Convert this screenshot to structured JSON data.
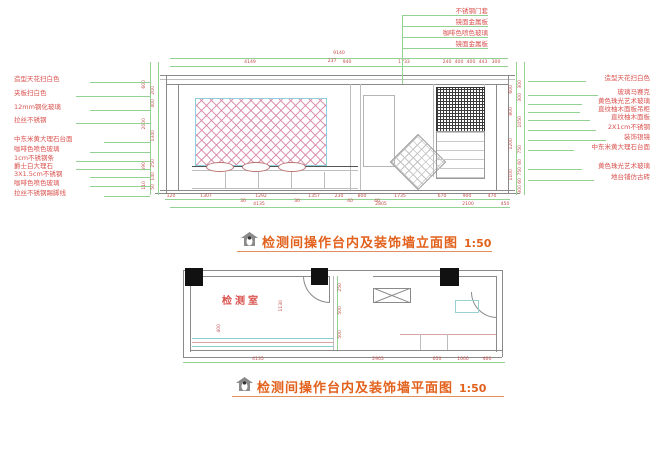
{
  "titles": {
    "elevation": {
      "text": "检测间操作台内及装饰墙立面图",
      "scale": "1:50"
    },
    "plan": {
      "text": "检测间操作台内及装饰墙平面图",
      "scale": "1:50"
    }
  },
  "colors": {
    "title_orange": "#e2611c",
    "callout_red": "#d9534f",
    "dim_red": "#c0504d",
    "dim_green": "#93d293",
    "line_gray": "#8a8a8a",
    "cyan": "#86cfcf",
    "hatch_pink": "#d884a6",
    "mosaic_dark": "#3a3a3a"
  },
  "elevation": {
    "top_callouts": [
      "不锈钢门套",
      "镜面金属板",
      "咖啡色喷色玻璃",
      "镜面金属板"
    ],
    "left_callouts": [
      "造型天花扫白色",
      "夹板扫白色",
      "12mm钢化玻璃",
      "拉丝不锈钢",
      "中东米黄大理石台面",
      "咖啡色喷色玻璃",
      "1cm不锈钢条",
      "爵士白大理石",
      "3X1.5cm不锈钢",
      "咖啡色喷色玻璃",
      "拉丝不锈钢踢脚线"
    ],
    "right_callouts": [
      "造型天花扫白色",
      "玻璃马赛克",
      "黄色珠光艺术玻璃",
      "直纹柚木面板吊柜",
      "直纹柚木面板",
      "2X1cm不锈钢",
      "装饰银镜",
      "中东米黄大理石台面",
      "黄色珠光艺术玻璃",
      "地台铺仿古砖"
    ],
    "dim_total": "9140",
    "dim_237": "237",
    "dims_top": [
      "4149",
      "940",
      "1733",
      "240",
      "400",
      "400",
      "443",
      "300"
    ],
    "dims_bottom_r1": [
      "120",
      "1307",
      "30",
      "1292",
      "30",
      "1357",
      "230",
      "40",
      "800",
      "40",
      "1735",
      "670",
      "900",
      "470"
    ],
    "dims_bottom_r2": [
      "4135",
      "2805",
      "2100",
      "450"
    ],
    "dims_left_outer": [
      "600",
      "2000",
      "590",
      "110"
    ],
    "dims_left_inner": [
      "200",
      "400",
      "1340",
      "250",
      "140",
      "50"
    ],
    "dims_right_inner": [
      "600",
      "800",
      "1200",
      "1100"
    ],
    "dims_right_outer": [
      "300",
      "300",
      "1050",
      "750",
      "60",
      "750",
      "60",
      "300"
    ]
  },
  "plan": {
    "room_label": "检测室",
    "dims_bottom": [
      "4135",
      "2905",
      "650",
      "1000",
      "460"
    ],
    "dims_inner": [
      "1130",
      "400",
      "250",
      "500",
      "500"
    ]
  }
}
